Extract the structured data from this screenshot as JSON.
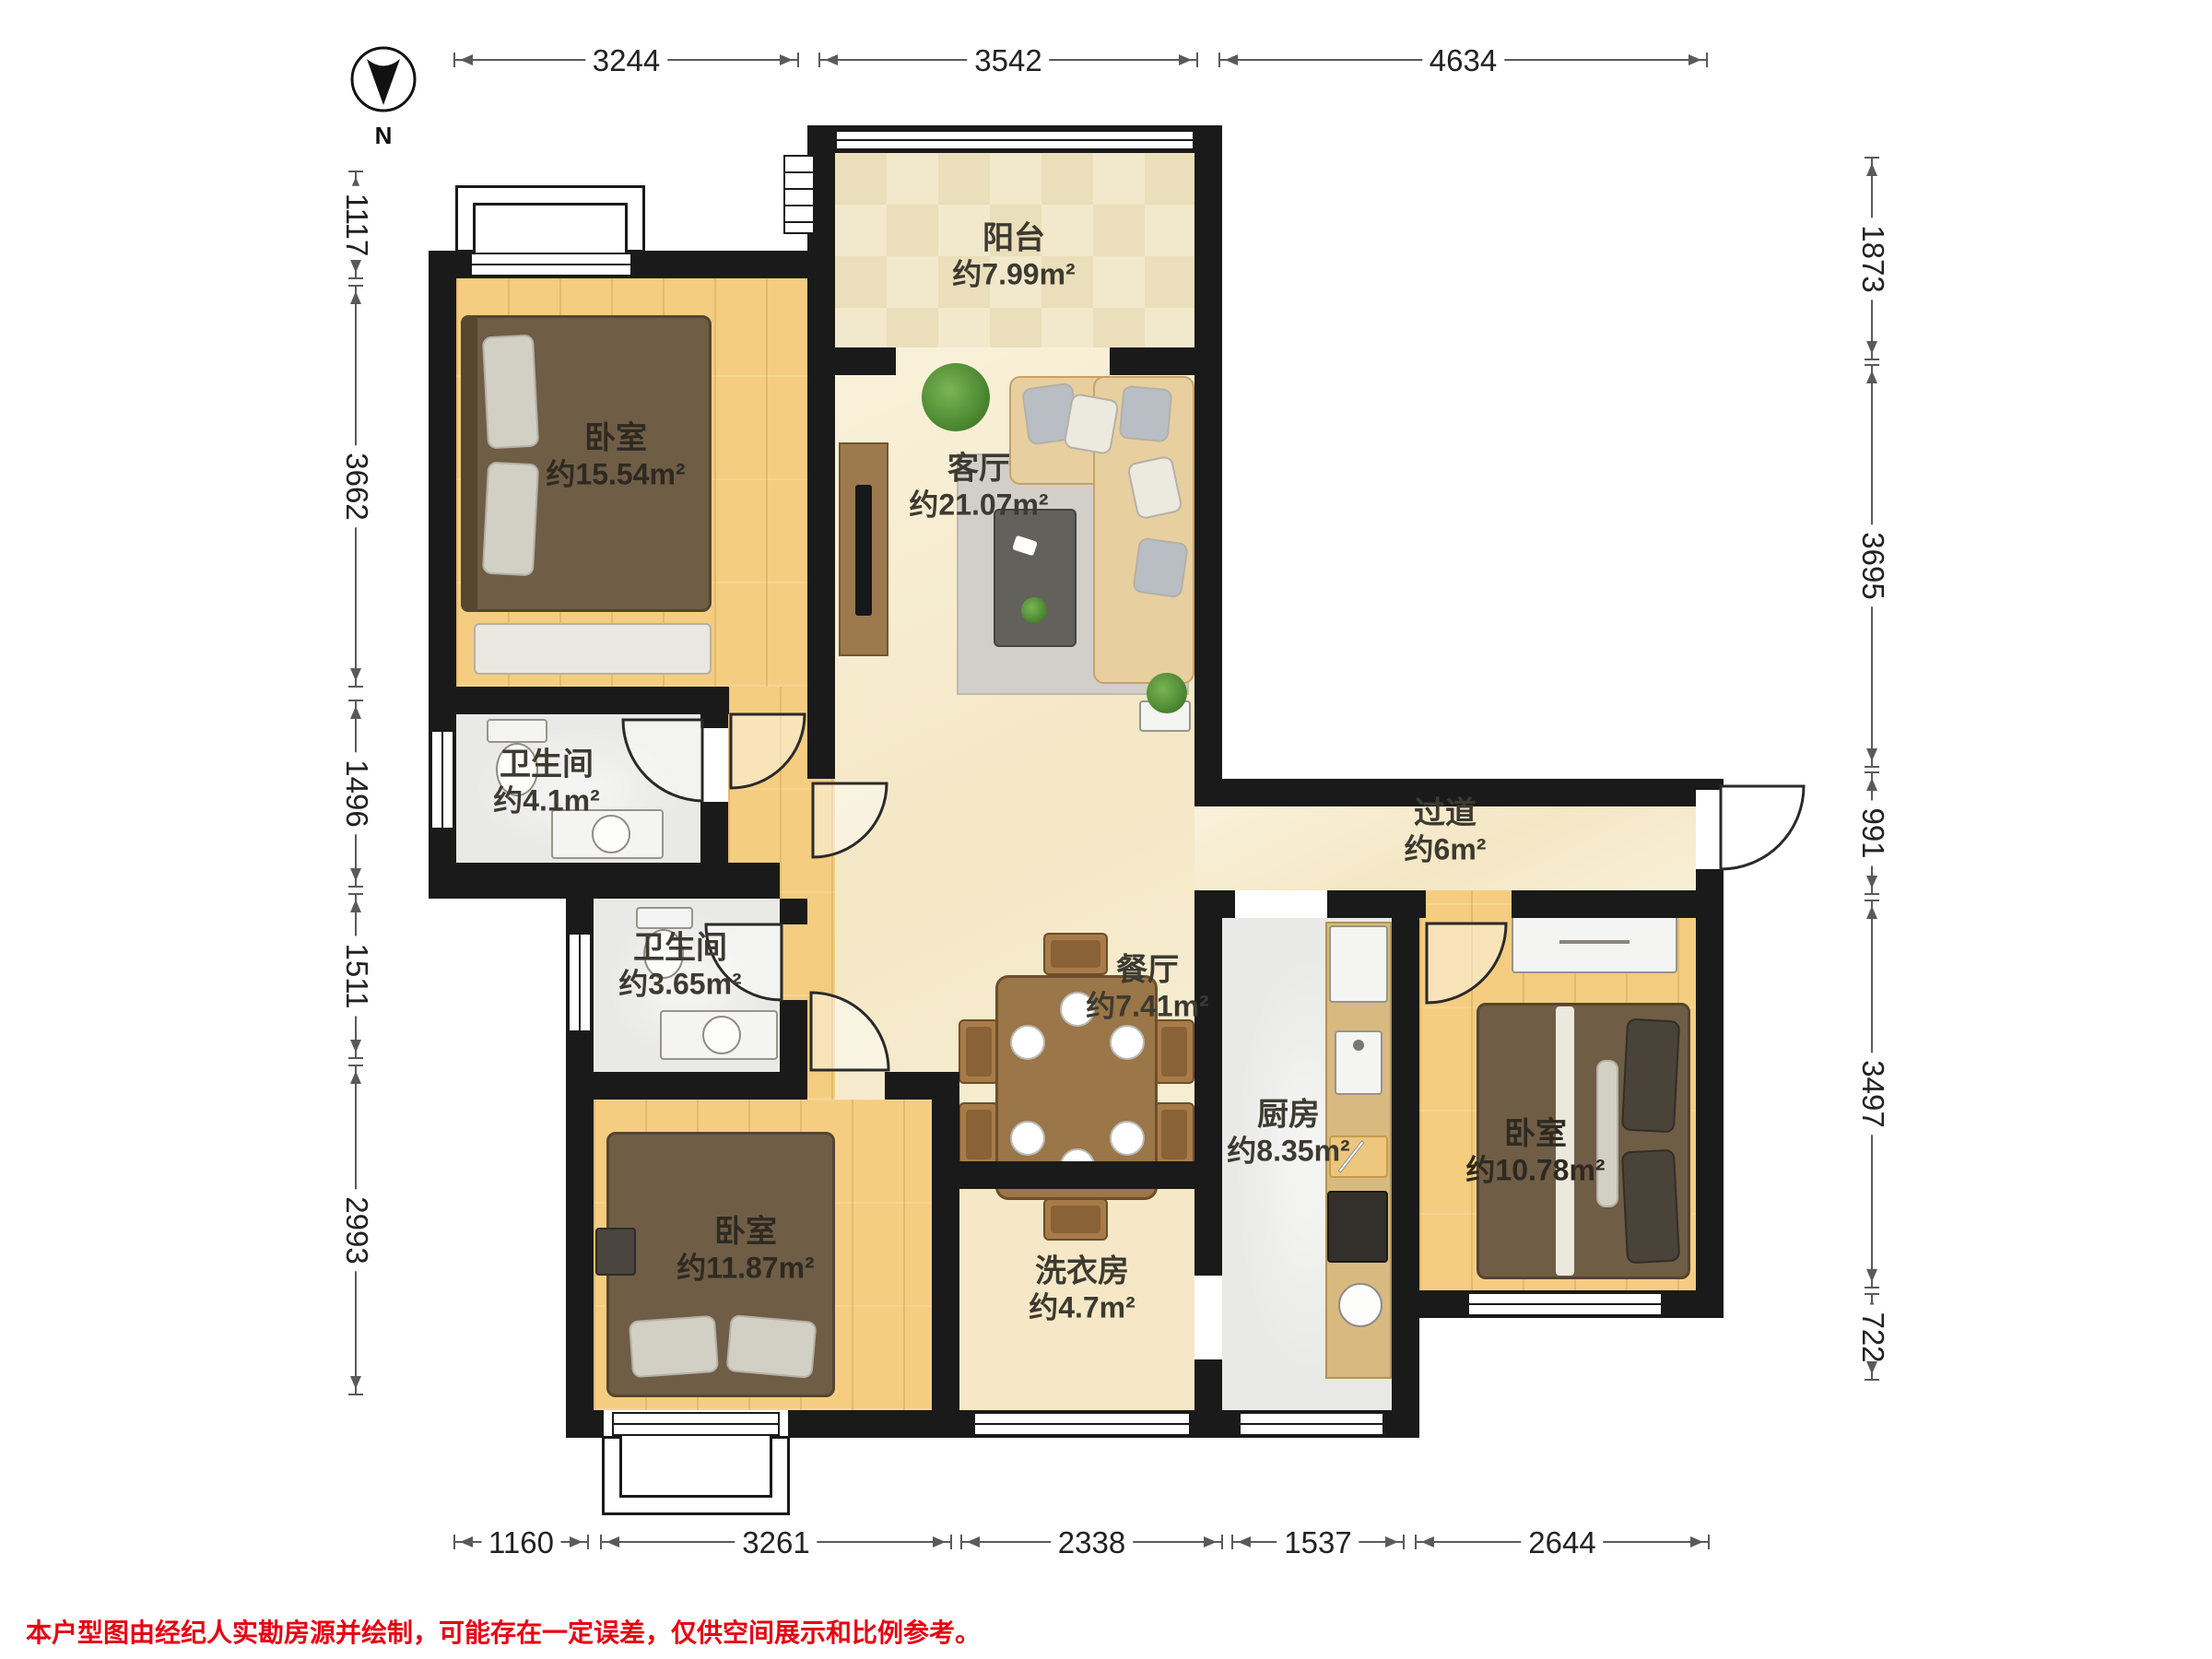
{
  "compass": {
    "label": "N"
  },
  "disclaimer": "本户型图由经纪人实勘房源并绘制，可能存在一定误差，仅供空间展示和比例参考。",
  "rooms": {
    "balcony": {
      "name": "阳台",
      "area": "约7.99m²"
    },
    "bedroom_tl": {
      "name": "卧室",
      "area": "约15.54m²"
    },
    "living": {
      "name": "客厅",
      "area": "约21.07m²"
    },
    "bath1": {
      "name": "卫生间",
      "area": "约4.1m²"
    },
    "bath2": {
      "name": "卫生间",
      "area": "约3.65m²"
    },
    "hallway": {
      "name": "过道",
      "area": "约6m²"
    },
    "dining": {
      "name": "餐厅",
      "area": "约7.41m²"
    },
    "kitchen": {
      "name": "厨房",
      "area": "约8.35m²"
    },
    "bedroom_r": {
      "name": "卧室",
      "area": "约10.78m²"
    },
    "bedroom_bl": {
      "name": "卧室",
      "area": "约11.87m²"
    },
    "laundry": {
      "name": "洗衣房",
      "area": "约4.7m²"
    }
  },
  "dimensions": {
    "top": [
      "3244",
      "3542",
      "4634"
    ],
    "bottom": [
      "1160",
      "3261",
      "2338",
      "1537",
      "2644"
    ],
    "left": [
      "1117",
      "3662",
      "1496",
      "1511",
      "2993"
    ],
    "right": [
      "1873",
      "3695",
      "991",
      "3497",
      "722"
    ]
  },
  "colors": {
    "wall": "#1a1a1a",
    "wood_floor": "#f4cd80",
    "marble_floor": "#f6ecce",
    "tile_floor": "#e9e9e7",
    "laundry_floor": "#f6e8c6",
    "balcony_tile_a": "#f2e9cc",
    "balcony_tile_b": "#eadfba",
    "bed": "#6f5d46",
    "sofa": "#e8cfa0",
    "dining_table": "#9a7648",
    "disclaimer_red": "#e60012"
  }
}
